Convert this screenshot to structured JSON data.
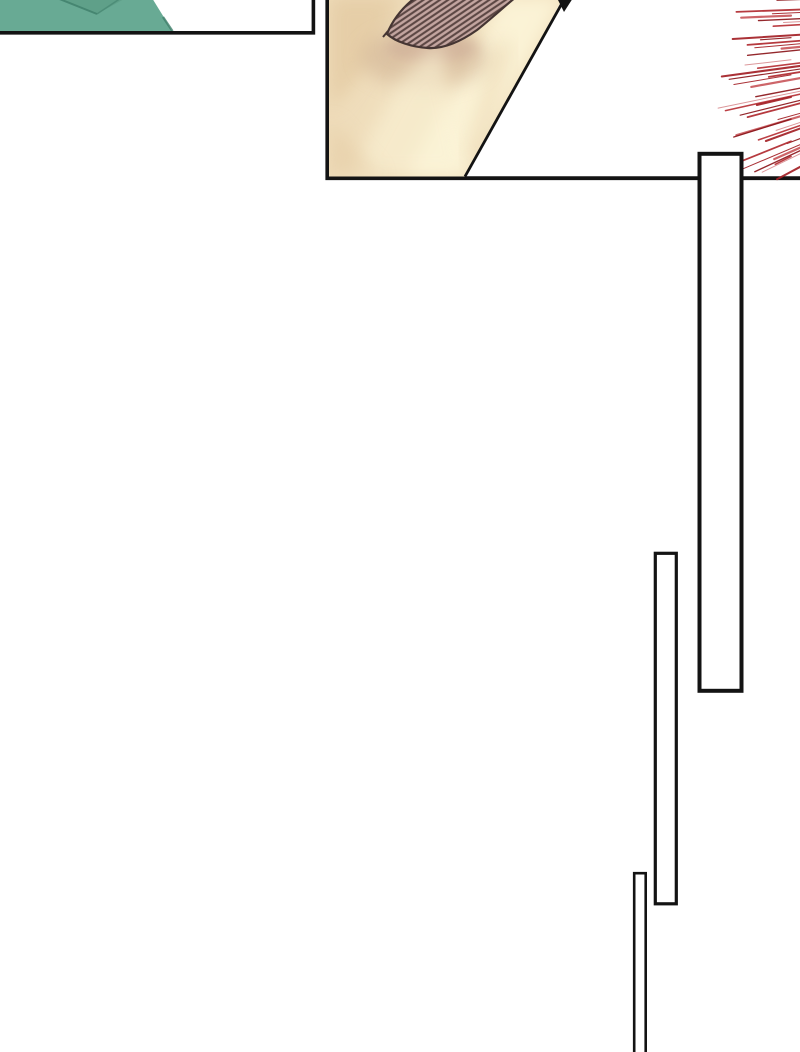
{
  "scene": {
    "kind": "webtoon-comic-page-fragment",
    "panels": [
      {
        "id": "panel-top-left",
        "content": "teal garment shoulder close-up, white background"
      },
      {
        "id": "panel-face",
        "content": "extreme close-up of face with hatched eyebrow and cheek, diagonal face outline"
      },
      {
        "id": "speed-lines",
        "content": "red action speed lines bursting from right edge"
      },
      {
        "id": "inset-panel-tall",
        "content": "empty tall white panel with black border"
      },
      {
        "id": "inset-panel-mid",
        "content": "empty narrow white panel with black border"
      },
      {
        "id": "inset-panel-bottom",
        "content": "empty very narrow white panel running off bottom edge"
      }
    ]
  },
  "palette": {
    "paper": "#ffffff",
    "ink": "#131313",
    "teal": "#68aa94",
    "teal-dark": "#57987f",
    "teal-deep": "#41806c",
    "skin-base": "#efddbb",
    "skin-light": "#fbf3d6",
    "skin-shadow": "#e3c9a1",
    "skin-shadow2": "#cfb092",
    "brow-shadow": "#c9a795",
    "brow-base": "#c3a5a0",
    "brow-stripe": "#5c4744",
    "brow-edge": "#453533"
  },
  "speed_lines": {
    "count": 40,
    "x_right": 801,
    "y_top": 3,
    "y_bottom": 164,
    "angle_min_deg": 2,
    "angle_max_deg": 28,
    "len_min": 24,
    "len_max": 72,
    "colors": [
      "#8c161b",
      "#b02a2f",
      "#a32026",
      "#c9595d",
      "#8c161b",
      "#d98f92",
      "#b73036",
      "#a32026"
    ],
    "widths": [
      1.2,
      1.8,
      1.0,
      2.2,
      1.4,
      1.0,
      1.6,
      2.0
    ]
  }
}
